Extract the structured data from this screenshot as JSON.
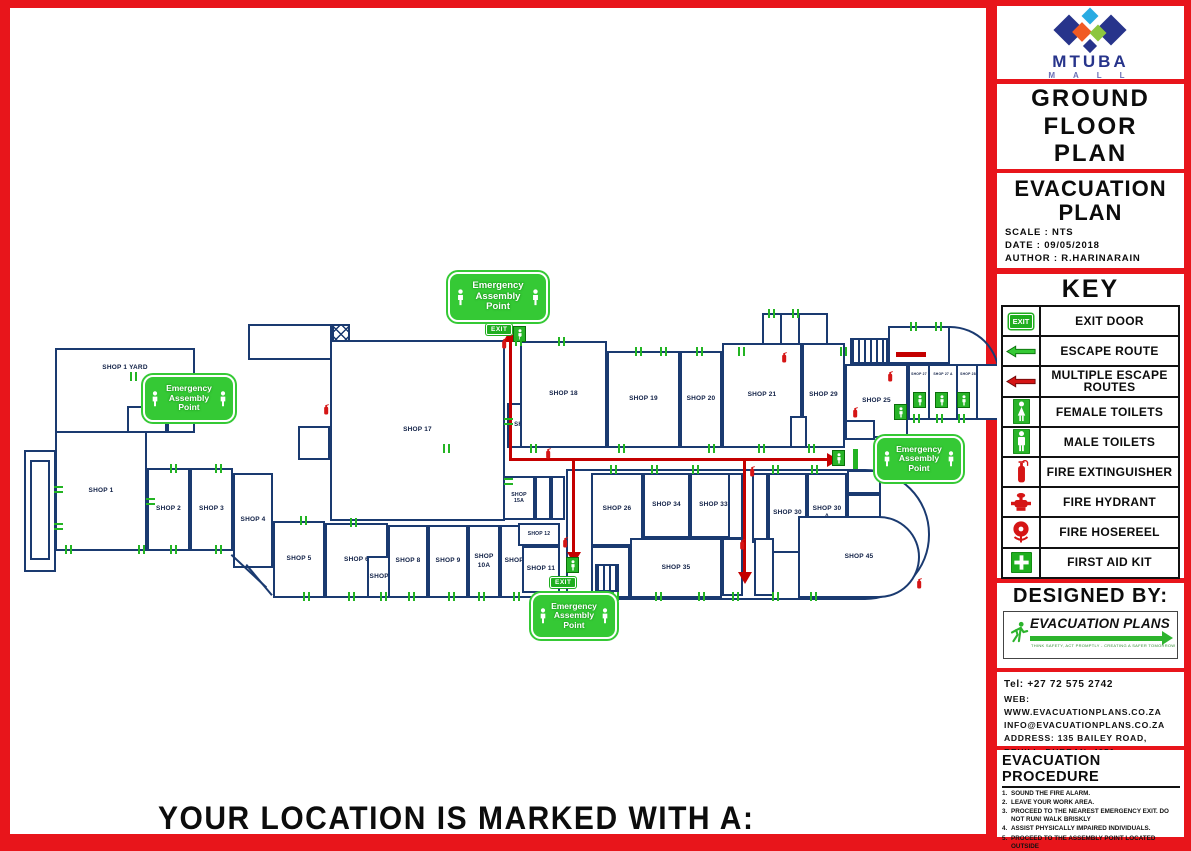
{
  "branding": {
    "name": "MTUBA",
    "sub": "M A L L"
  },
  "title_panel": {
    "line1": "GROUND",
    "line2": "FLOOR",
    "line3": "PLAN"
  },
  "plan_panel": {
    "title1": "EVACUATION",
    "title2": "PLAN",
    "scale": "SCALE : NTS",
    "date": "DATE : 09/05/2018",
    "author": "AUTHOR : R.HARINARAIN"
  },
  "key": {
    "title": "KEY",
    "items": [
      {
        "icon": "exit-door-icon",
        "icon_text": "EXIT",
        "label": "EXIT DOOR"
      },
      {
        "icon": "escape-route-arrow-icon",
        "label": "ESCAPE ROUTE"
      },
      {
        "icon": "multiple-escape-routes-arrow-icon",
        "label": "MULTIPLE ESCAPE ROUTES"
      },
      {
        "icon": "female-toilets-icon",
        "label": "FEMALE TOILETS"
      },
      {
        "icon": "male-toilets-icon",
        "label": "MALE TOILETS"
      },
      {
        "icon": "fire-extinguisher-icon",
        "label": "FIRE EXTINGUISHER"
      },
      {
        "icon": "fire-hydrant-icon",
        "label": "FIRE HYDRANT"
      },
      {
        "icon": "fire-hosereel-icon",
        "label": "FIRE HOSEREEL"
      },
      {
        "icon": "first-aid-kit-icon",
        "label": "FIRST AID KIT"
      }
    ]
  },
  "designed_by": {
    "title": "DESIGNED BY:",
    "logo_text": "EVACUATION PLANS",
    "tagline": "THINK SAFETY, ACT PROMPTLY - CREATING A SAFER TOMORROW"
  },
  "contact": {
    "tel": "Tel: +27 72 575 2742",
    "web": "WEB: WWW.EVACUATIONPLANS.CO.ZA",
    "email": "INFO@EVACUATIONPLANS.CO.ZA",
    "address1": "ADDRESS: 135 BAILEY ROAD,",
    "address2": "REHILL, DURBAN, 4051"
  },
  "procedure": {
    "title": "EVACUATION PROCEDURE",
    "steps": [
      {
        "num": "1.",
        "text": "SOUND THE FIRE ALARM."
      },
      {
        "num": "2.",
        "text": "LEAVE YOUR WORK AREA."
      },
      {
        "num": "3.",
        "text": "PROCEED TO THE NEAREST EMERGENCY EXIT. DO NOT RUN! WALK BRISKLY"
      },
      {
        "num": "4.",
        "text": "ASSIST PHYSICALLY IMPAIRED INDIVIDUALS."
      },
      {
        "num": "5.",
        "text": "PROCEED TO THE ASSEMBLY POINT LOCATED OUTSIDE"
      }
    ]
  },
  "floorplan": {
    "assembly_label": "Emergency Assembly Point",
    "exit_label": "EXIT",
    "footer": "YOUR LOCATION IS MARKED WITH A:",
    "shops": [
      {
        "label": "SHOP 1 YARD"
      },
      {
        "label": "SHOP 1"
      },
      {
        "label": "SHOP 2"
      },
      {
        "label": "SHOP 3"
      },
      {
        "label": "SHOP 4"
      },
      {
        "label": "SHOP 5"
      },
      {
        "label": "SHOP 6"
      },
      {
        "label": "SHOP 7"
      },
      {
        "label": "SHOP 8"
      },
      {
        "label": "SHOP 9"
      },
      {
        "label": "SHOP 10A"
      },
      {
        "label": "SHOP 10"
      },
      {
        "label": "SHOP 11"
      },
      {
        "label": "SHOP 12"
      },
      {
        "label": "SHOP 15A"
      },
      {
        "label": "SHOP 16"
      },
      {
        "label": "SHOP 17"
      },
      {
        "label": "SHOP 18"
      },
      {
        "label": "SHOP 19"
      },
      {
        "label": "SHOP 20"
      },
      {
        "label": "SHOP 21"
      },
      {
        "label": "SHOP 29"
      },
      {
        "label": "SHOP 25"
      },
      {
        "label": "SHOP 26"
      },
      {
        "label": "SHOP 34"
      },
      {
        "label": "SHOP 33"
      },
      {
        "label": "SHOP 30"
      },
      {
        "label": "SHOP 30 A"
      },
      {
        "label": "SHOP 35"
      },
      {
        "label": "SHOP 45"
      },
      {
        "label": "SHOP 27"
      },
      {
        "label": "SHOP 27 A"
      },
      {
        "label": "SHOP 28"
      }
    ]
  },
  "colors": {
    "border_red": "#e8151b",
    "wall_navy": "#1a3a70",
    "safety_green": "#28b428",
    "route_red": "#c40000"
  }
}
